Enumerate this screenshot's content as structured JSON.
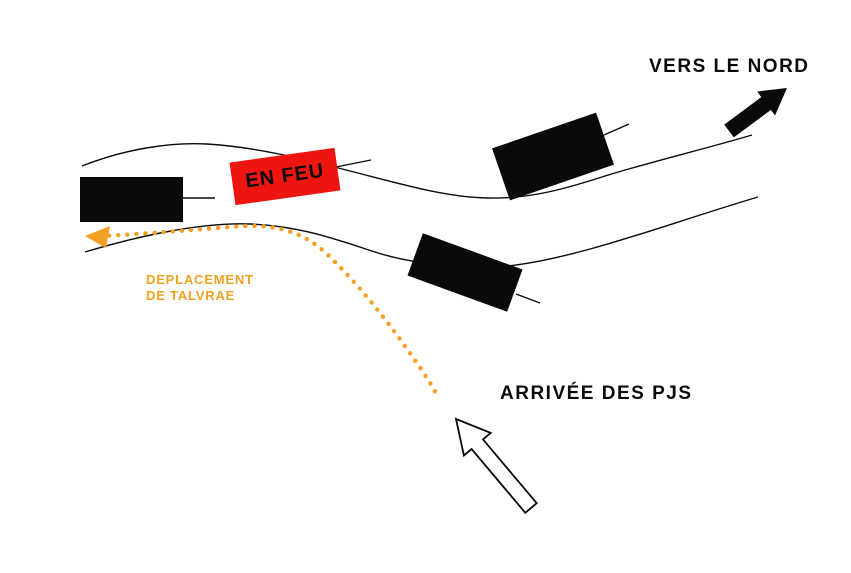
{
  "diagram": {
    "labels": {
      "north_direction": "VERS LE NORD",
      "burning_building": "EN FEU",
      "movement_line1": "DEPLACEMENT",
      "movement_line2": "DE TALVRAE",
      "pcs_arrival": "ARRIVÉE DES PJS"
    },
    "colors": {
      "ink": "#0a0a0a",
      "fire_red": "#ee1510",
      "trail_orange": "#f2a024",
      "background": "#ffffff",
      "arrival_arrow_fill": "#ffffff"
    },
    "icons": {
      "north_arrow": "solid-arrow-up-right",
      "arrival_arrow": "outline-arrow-up-left",
      "movement_trail": "dotted-curved-arrow-pointing-left"
    }
  }
}
